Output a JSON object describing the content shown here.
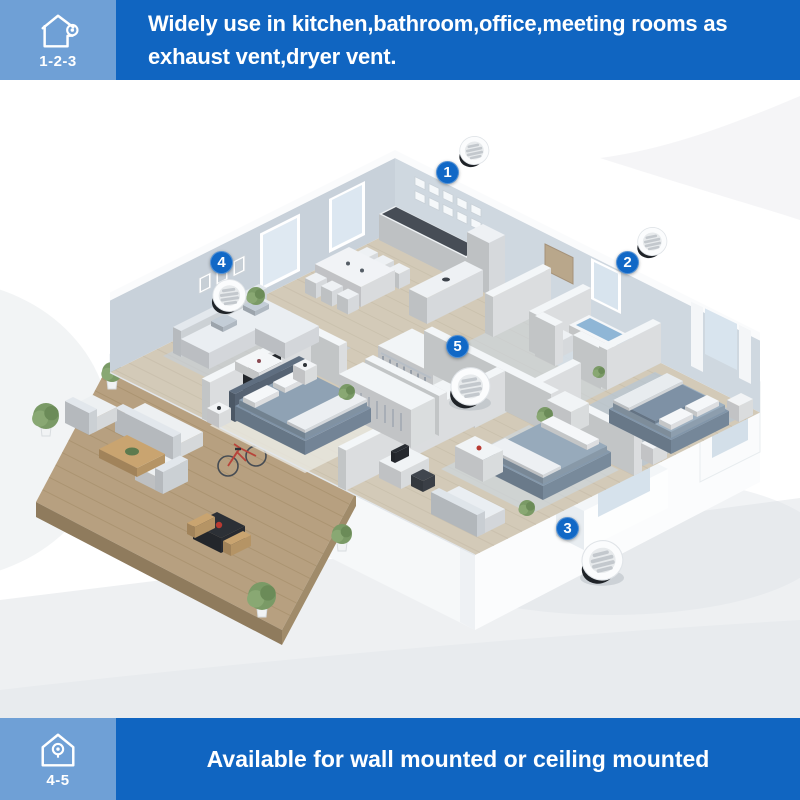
{
  "header": {
    "badge_label": "1-2-3",
    "line1": "Widely use in kitchen,bathroom,office,meeting rooms as",
    "line2": "exhaust vent,dryer vent."
  },
  "footer": {
    "badge_label": "4-5",
    "text": "Available for wall mounted or ceiling mounted"
  },
  "markers": [
    {
      "label": "1"
    },
    {
      "label": "2"
    },
    {
      "label": "3"
    },
    {
      "label": "4"
    },
    {
      "label": "5"
    }
  ],
  "colors": {
    "banner_blue": "#1065c1",
    "banner_light_blue": "#6fa0d6",
    "marker_blue": "#1168c6",
    "deck_wood": "#b7a080",
    "wall_gray": "#c8d1da",
    "bed_gray": "#8296aa",
    "water_blue": "#8fb6d6"
  }
}
